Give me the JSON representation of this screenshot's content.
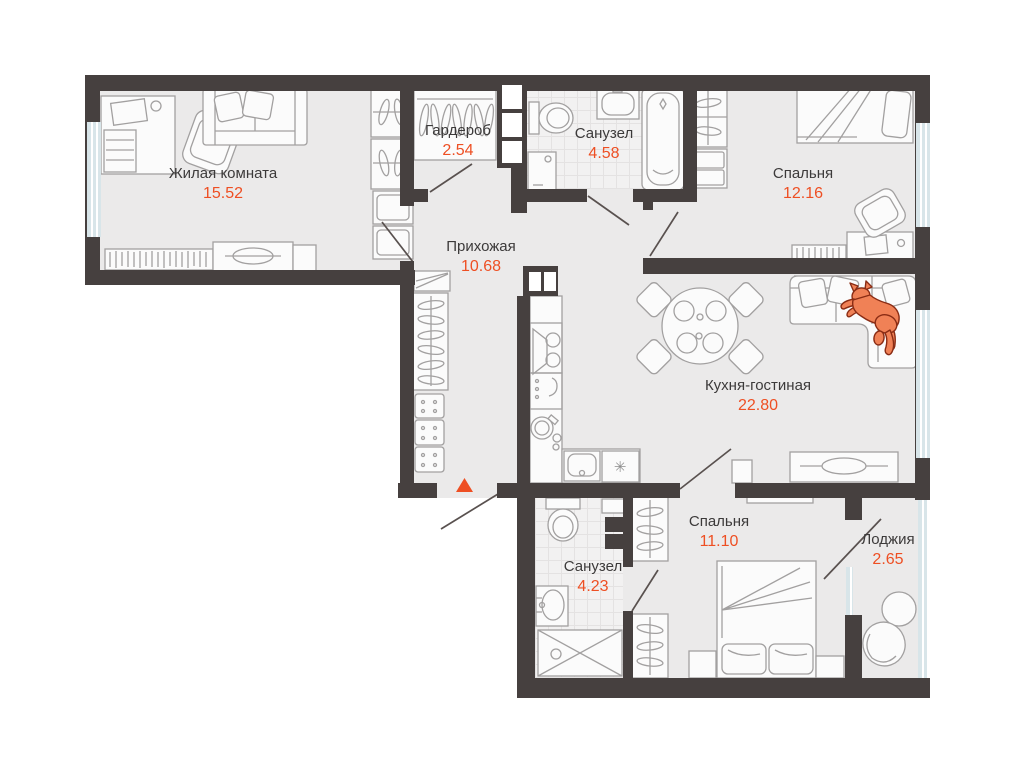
{
  "plan": {
    "rooms": [
      {
        "id": "living-room",
        "label": "Жилая комната",
        "area": "15.52"
      },
      {
        "id": "wardrobe-room",
        "label": "Гардероб",
        "area": "2.54"
      },
      {
        "id": "bathroom-top",
        "label": "Санузел",
        "area": "4.58"
      },
      {
        "id": "bedroom-top",
        "label": "Спальня",
        "area": "12.16"
      },
      {
        "id": "hallway",
        "label": "Прихожая",
        "area": "10.68"
      },
      {
        "id": "kitchen-living",
        "label": "Кухня-гостиная",
        "area": "22.80"
      },
      {
        "id": "bedroom-bottom",
        "label": "Спальня",
        "area": "11.10"
      },
      {
        "id": "bathroom-bottom",
        "label": "Санузел",
        "area": "4.23"
      },
      {
        "id": "loggia",
        "label": "Лоджия",
        "area": "2.65"
      }
    ],
    "markers": {
      "entry": "entry-arrow",
      "pet": "cat-icon",
      "washer_symbol": "✳"
    },
    "colors": {
      "wall": "#46403f",
      "floor": "#ebeaea",
      "accent": "#ee4f23",
      "furn": "#a2a0a0",
      "glass": "#d8e5e9",
      "cat": "#f08156",
      "catline": "#8a2c14",
      "text": "#3c3a3a",
      "tile": "#f2f1f1"
    }
  }
}
